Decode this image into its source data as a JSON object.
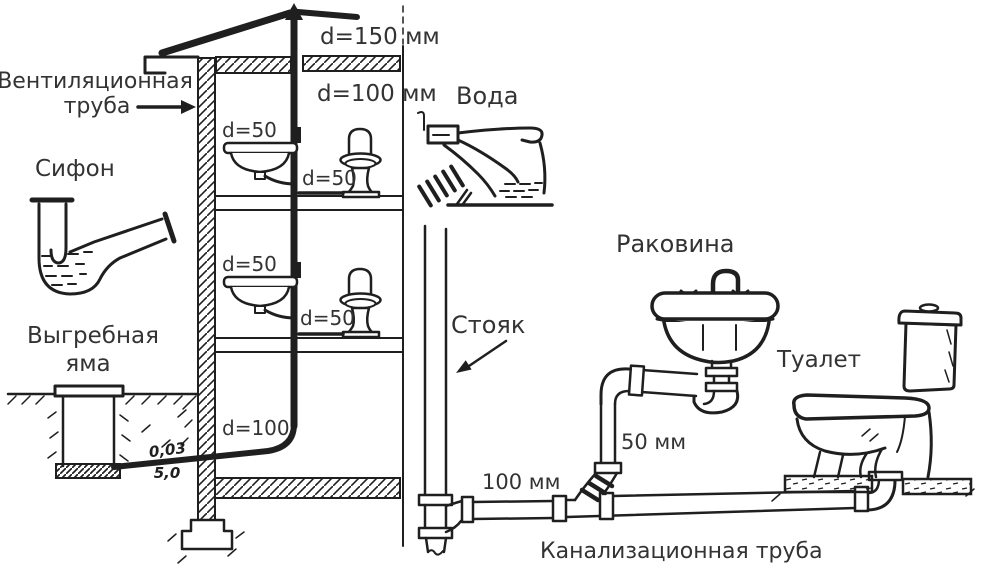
{
  "diagram": {
    "type": "plumbing-sewerage-scheme",
    "language": "ru",
    "colors": {
      "ink": "#1f1f1f",
      "text": "#333333",
      "background": "#ffffff"
    },
    "labels": {
      "vent_line1": "Вентиляционная",
      "vent_line2": "труба",
      "siphon": "Сифон",
      "cesspool_line1": "Выгребная",
      "cesspool_line2": "яма",
      "dim_roof": "d=150 мм",
      "dim_attic": "d=100 мм",
      "dim_sink_f1": "d=50",
      "dim_toilet_f1": "d=50",
      "dim_sink_f2": "d=50",
      "dim_toilet_f2": "d=50",
      "dim_riser_bottom": "d=100",
      "slope_value": "0,03",
      "slope_length": "5,0",
      "water": "Вода",
      "riser": "Стояк",
      "sink": "Раковина",
      "toilet": "Туалет",
      "pipe_50": "50 мм",
      "pipe_100": "100 мм",
      "sewer": "Канализационная труба"
    }
  }
}
